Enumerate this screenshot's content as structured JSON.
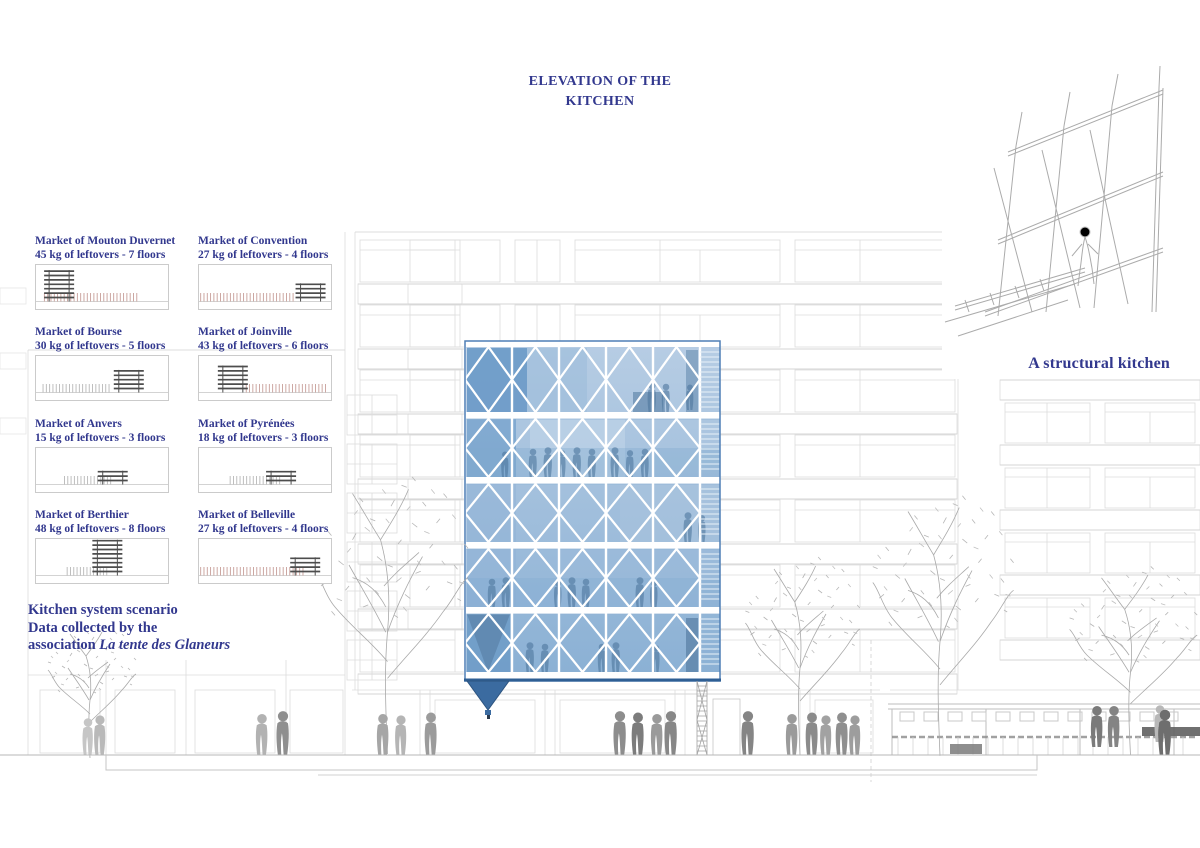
{
  "title": {
    "line1": "ELEVATION OF THE",
    "line2": "KITCHEN"
  },
  "captions": {
    "structural": "A structural kitchen",
    "scenario1": "Kitchen system scenario",
    "scenario2": "Data collected by the",
    "scenario3_prefix": "association ",
    "scenario3_italic": "La tente des Glaneurs"
  },
  "colors": {
    "heading_navy": "#32388e",
    "glass_blue_light": "#bcd1e6",
    "glass_blue": "#8fb3d6",
    "glass_blue_dark": "#3b6ba0",
    "tick_pink": "#c79e98",
    "tick_gray": "#b7b7b7",
    "structure_dark": "#4d4d4d",
    "facade_line": "#dcdcdc"
  },
  "markets": [
    {
      "name": "Market of Mouton Duvernet",
      "stat": "45 kg of leftovers - 7 floors",
      "kg": 45,
      "floors": 7,
      "structure_pos": 0.18,
      "ticks_from": 0.07,
      "ticks_to": 0.78,
      "tick_color": "pink"
    },
    {
      "name": "Market of Convention",
      "stat": "27 kg of leftovers - 4 floors",
      "kg": 27,
      "floors": 4,
      "structure_pos": 0.84,
      "ticks_from": 0.02,
      "ticks_to": 0.72,
      "tick_color": "pink"
    },
    {
      "name": "Market of Bourse",
      "stat": "30 kg of leftovers - 5 floors",
      "kg": 30,
      "floors": 5,
      "structure_pos": 0.7,
      "ticks_from": 0.06,
      "ticks_to": 0.56,
      "tick_color": "gray"
    },
    {
      "name": "Market of Joinville",
      "stat": "43 kg of leftovers - 6 floors",
      "kg": 43,
      "floors": 6,
      "structure_pos": 0.26,
      "ticks_from": 0.36,
      "ticks_to": 0.97,
      "tick_color": "pink"
    },
    {
      "name": "Market of Anvers",
      "stat": "15 kg of leftovers - 3 floors",
      "kg": 15,
      "floors": 3,
      "structure_pos": 0.58,
      "ticks_from": 0.22,
      "ticks_to": 0.58,
      "tick_color": "gray"
    },
    {
      "name": "Market of Pyrénées",
      "stat": "18 kg of leftovers - 3 floors",
      "kg": 18,
      "floors": 3,
      "structure_pos": 0.62,
      "ticks_from": 0.24,
      "ticks_to": 0.62,
      "tick_color": "gray"
    },
    {
      "name": "Market of Berthier",
      "stat": "48 kg of leftovers - 8 floors",
      "kg": 48,
      "floors": 8,
      "structure_pos": 0.54,
      "ticks_from": 0.24,
      "ticks_to": 0.56,
      "tick_color": "gray"
    },
    {
      "name": "Market of Belleville",
      "stat": "27 kg of leftovers - 4 floors",
      "kg": 27,
      "floors": 4,
      "structure_pos": 0.8,
      "ticks_from": 0.02,
      "ticks_to": 0.8,
      "tick_color": "pink"
    }
  ]
}
